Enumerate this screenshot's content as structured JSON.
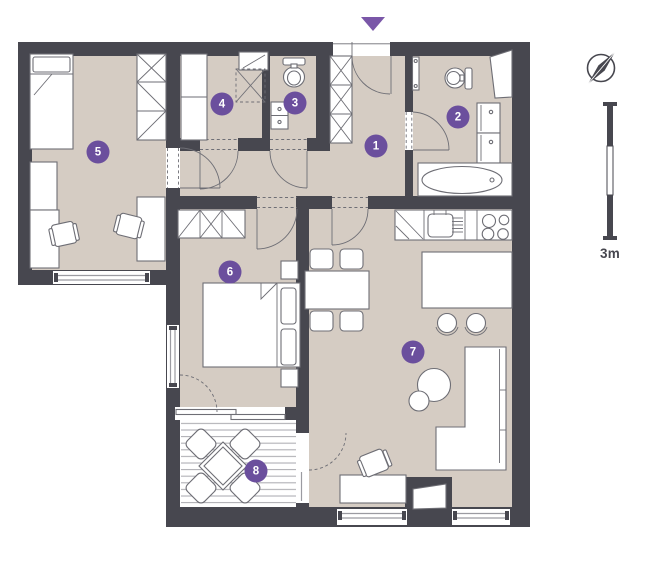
{
  "colors": {
    "wall": "#47474F",
    "floor": "#D5CCC3",
    "accent": "#6B4F9D",
    "accent2": "#7A57A8",
    "line": "#6E6E75",
    "glass": "#9B9BA1",
    "deck": "#B0B0B5"
  },
  "markers": [
    "1",
    "2",
    "3",
    "4",
    "5",
    "6",
    "7",
    "8"
  ],
  "scale": {
    "label": "3m"
  },
  "icons": {
    "compass": "compass-icon",
    "entrance": "entrance-arrow-icon",
    "scalebar": "scale-bar"
  }
}
